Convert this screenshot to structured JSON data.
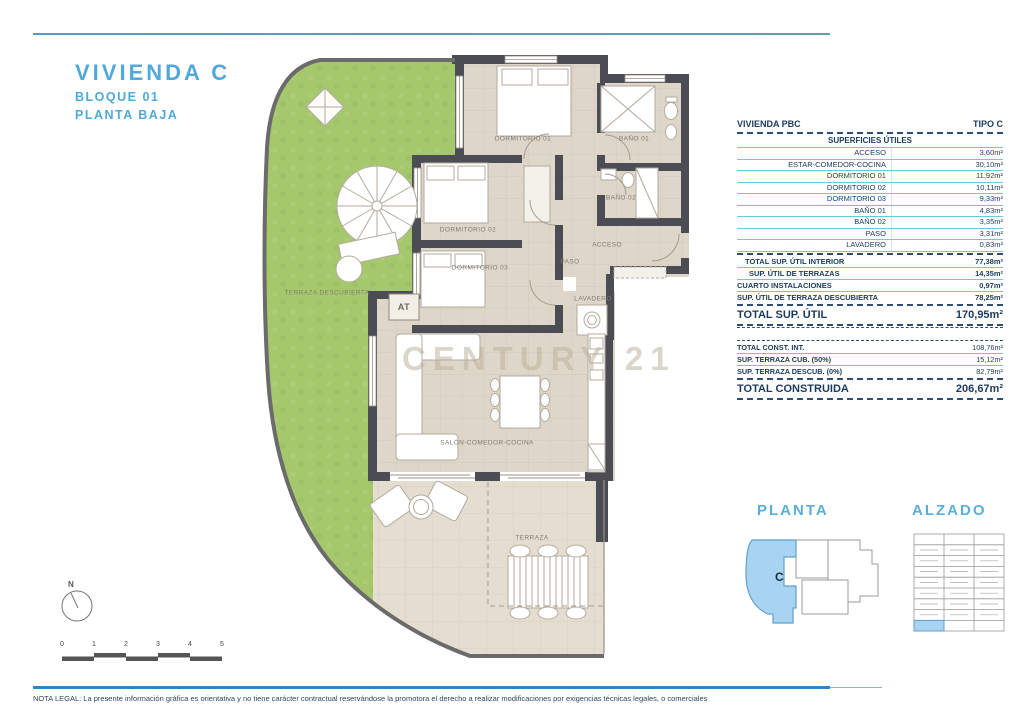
{
  "title": {
    "main": "VIVIENDA C",
    "line2": "BLOQUE 01",
    "line3": "PLANTA BAJA"
  },
  "table": {
    "header_left": "VIVIENDA PBC",
    "header_right": "TIPO C",
    "section_title": "SUPERFICIES ÚTILES",
    "rows": [
      {
        "label": "ACCESO",
        "value": "3,60m²"
      },
      {
        "label": "ESTAR-COMEDOR-COCINA",
        "value": "30,10m²"
      },
      {
        "label": "DORMITORIO 01",
        "value": "11,92m²"
      },
      {
        "label": "DORMITORIO 02",
        "value": "10,11m²"
      },
      {
        "label": "DORMITORIO 03",
        "value": "9,33m²"
      },
      {
        "label": "BAÑO 01",
        "value": "4,83m²"
      },
      {
        "label": "BAÑO 02",
        "value": "3,35m²"
      },
      {
        "label": "PASO",
        "value": "3,31m²"
      },
      {
        "label": "LAVADERO",
        "value": "0,83m²"
      }
    ],
    "subtotals": [
      {
        "label": "TOTAL SUP. ÚTIL INTERIOR",
        "value": "77,38m²"
      },
      {
        "label": "SUP. ÚTIL DE TERRAZAS",
        "value": "14,35m²"
      },
      {
        "label": "CUARTO INSTALACIONES",
        "value": "0,97m²"
      },
      {
        "label": "SUP. ÚTIL DE TERRAZA DESCUBIERTA",
        "value": "78,25m²"
      }
    ],
    "total_util": {
      "label": "TOTAL SUP. ÚTIL",
      "value": "170,95m²"
    },
    "construida_rows": [
      {
        "label": "TOTAL CONST. INT.",
        "value": "108,76m²"
      },
      {
        "label": "SUP. TERRAZA CUB. (50%)",
        "value": "15,12m²"
      },
      {
        "label": "SUP. TERRAZA DESCUB. (0%)",
        "value": "82,79m²"
      }
    ],
    "total_construida": {
      "label": "TOTAL CONSTRUIDA",
      "value": "206,67m²"
    }
  },
  "plan": {
    "labels": {
      "dormitorio1": "DORMITORIO 01",
      "bano1": "BAÑO 01",
      "dormitorio2": "DORMITORIO 02",
      "bano2": "BAÑO 02",
      "dormitorio3": "DORMITORIO 03",
      "acceso": "ACCESO",
      "paso": "PASO",
      "lavadero": "LAVADERO",
      "at": "AT",
      "salon": "SALÓN-COMEDOR-COCINA",
      "terraza": "TERRAZA",
      "terraza_descubierta": "TERRAZA DESCUBIERTA"
    }
  },
  "key_plans": {
    "planta_title": "PLANTA",
    "alzado_title": "ALZADO",
    "unit_letter": "C"
  },
  "compass": {
    "north": "N"
  },
  "scale": {
    "labels": [
      "0",
      "1",
      "2",
      "3",
      "4",
      "5"
    ]
  },
  "watermark": "CENTURY 21",
  "legal": "NOTA LEGAL: La presente información gráfica es orientativa y no tiene carácter contractual reservándose la promotora el derecho a realizar modificaciones por exigencias técnicas legales, o comerciales",
  "colors": {
    "accent_blue": "#4fa9da",
    "table_navy": "#1c3a5e",
    "cyan_line": "#6cc6dc",
    "wall": "#4c4c55",
    "garden": "#a6c86d",
    "floor": "#ded6c8",
    "terrace": "#e4dccd",
    "highlight_blue": "#a9d4f1"
  }
}
